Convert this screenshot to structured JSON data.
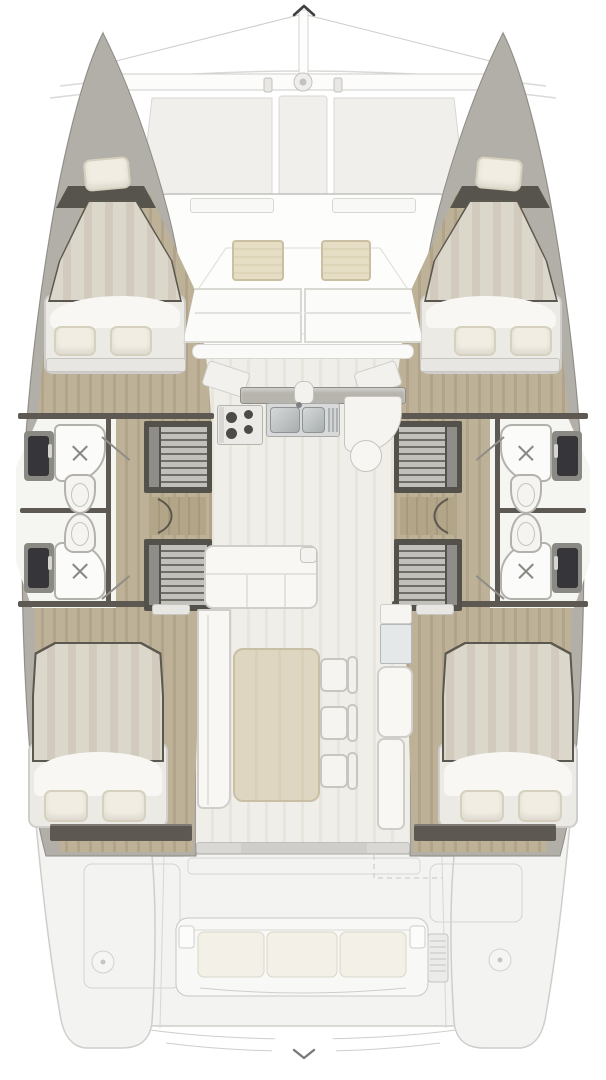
{
  "page": {
    "background": "#ffffff"
  },
  "scroll_controls": {
    "up": {
      "icon": "chevron-up"
    },
    "down": {
      "icon": "chevron-down"
    }
  },
  "plan": {
    "type": "catamaran-deck-plan",
    "areas": [
      "trampoline",
      "forward-cockpit",
      "left-hull-forward-cabin",
      "left-hull-forward-head",
      "left-hull-aft-head",
      "left-hull-aft-cabin",
      "right-hull-forward-cabin",
      "right-hull-forward-head",
      "right-hull-aft-head",
      "right-hull-aft-cabin",
      "galley",
      "saloon",
      "nav-station",
      "aft-cockpit",
      "stern-bench",
      "transom-steps"
    ]
  },
  "colors": {
    "bg": "#ffffff",
    "faded_stroke": "#cfcecb",
    "faded_fill": "#f3f3f1",
    "panel_fill": "#f0efec",
    "panel_stroke": "#d8d7d3",
    "hull_wall": "#b2afa9",
    "hull_edge": "#8e8b85",
    "wood": "#bdb198",
    "wood_stripe": "#b1a48a",
    "bow_shadow": "#57544d",
    "wall_dark": "#5d5952",
    "bathroom_floor": "#f5f5f2",
    "fixture_white": "#fbfbf9",
    "fixture_edge": "#b3b1ac",
    "vanity_dark": "#36363a",
    "vanity_base": "#8b8984",
    "stair_frame": "#54514a",
    "stair_step": "#c2c0ba",
    "stair_dark": "#6f6d66",
    "landing_wood": "#b3a587",
    "duvet": "#dcd7cb",
    "duvet_stripe": "#d2cbbd",
    "bed_edge": "#5b5850",
    "fold_white": "#f8f7f4",
    "pillow": "#f1ede2",
    "pillow_edge": "#d6d0bf",
    "platform": "#eceae5",
    "saloon_floor": "#efeee8",
    "saloon_stripe": "#e8e6dc",
    "white_soft": "#f8f7f4",
    "trim": "#cfceca",
    "counter_edge_dark": "#b7b4ae",
    "metal": "#c8cbcc",
    "metal_dark": "#8f9394",
    "burner": "#4b4b47",
    "cushion": "#e6ddc5",
    "cushion_edge": "#cabfa3",
    "table": "#ded6c0",
    "table_edge": "#c8bfa5",
    "glass": "#e4e8e9",
    "bench_cushion": "#f3f1e7",
    "chevron_up": "#3e3e44",
    "chevron_down": "#7a7a7a"
  }
}
